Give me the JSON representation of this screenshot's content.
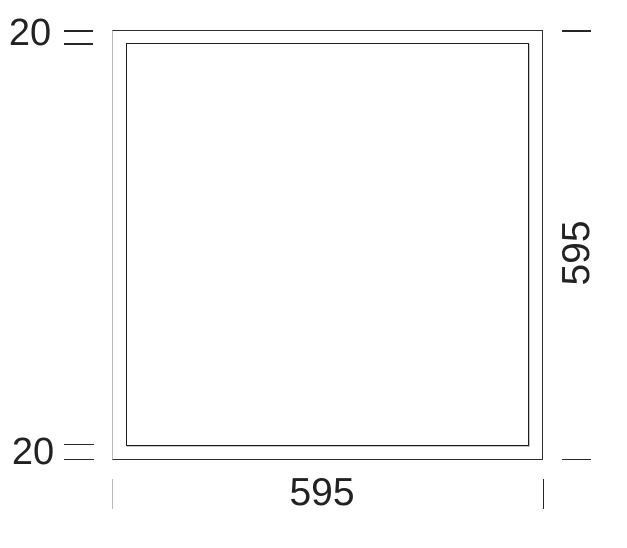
{
  "figure": {
    "type": "dimensioned-technical-drawing",
    "subject": "square panel front view with outer frame and inner inset outline",
    "labels": {
      "border_top": "20",
      "border_bottom": "20",
      "width_bottom": "595",
      "height_right": "595"
    },
    "colors": {
      "line": "#262626",
      "muted_line": "#b5b9b8",
      "text": "#222222",
      "background": "#ffffff"
    }
  }
}
